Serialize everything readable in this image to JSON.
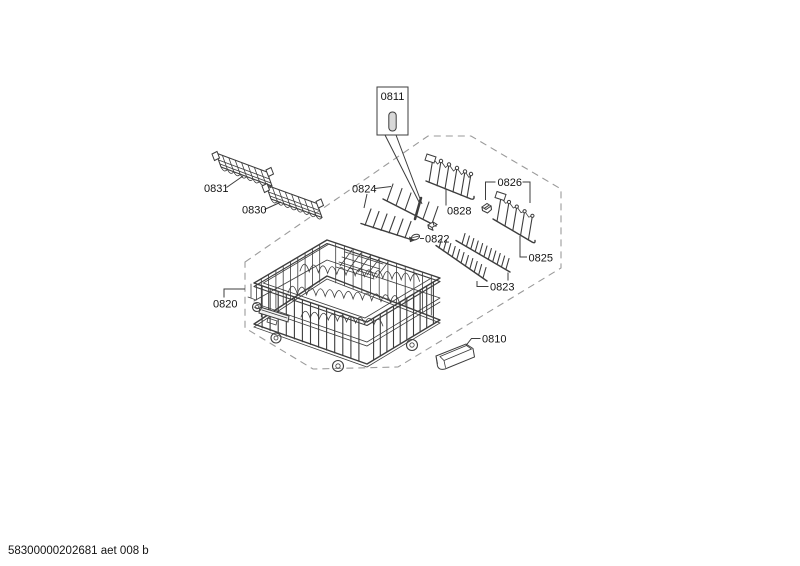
{
  "footer": {
    "code": "58300000202681 aet 008 b"
  },
  "parts": {
    "p0811": {
      "label": "0811"
    },
    "p0831": {
      "label": "0831"
    },
    "p0830": {
      "label": "0830"
    },
    "p0824": {
      "label": "0824"
    },
    "p0828": {
      "label": "0828"
    },
    "p0826": {
      "label": "0826"
    },
    "p0822": {
      "label": "0822"
    },
    "p0825": {
      "label": "0825"
    },
    "p0823": {
      "label": "0823"
    },
    "p0820": {
      "label": "0820"
    },
    "p0810": {
      "label": "0810"
    }
  },
  "colors": {
    "line": "#3d3d3d",
    "dash": "#9a9a9a",
    "text": "#141414",
    "pin_fill": "#d8d8d8"
  }
}
